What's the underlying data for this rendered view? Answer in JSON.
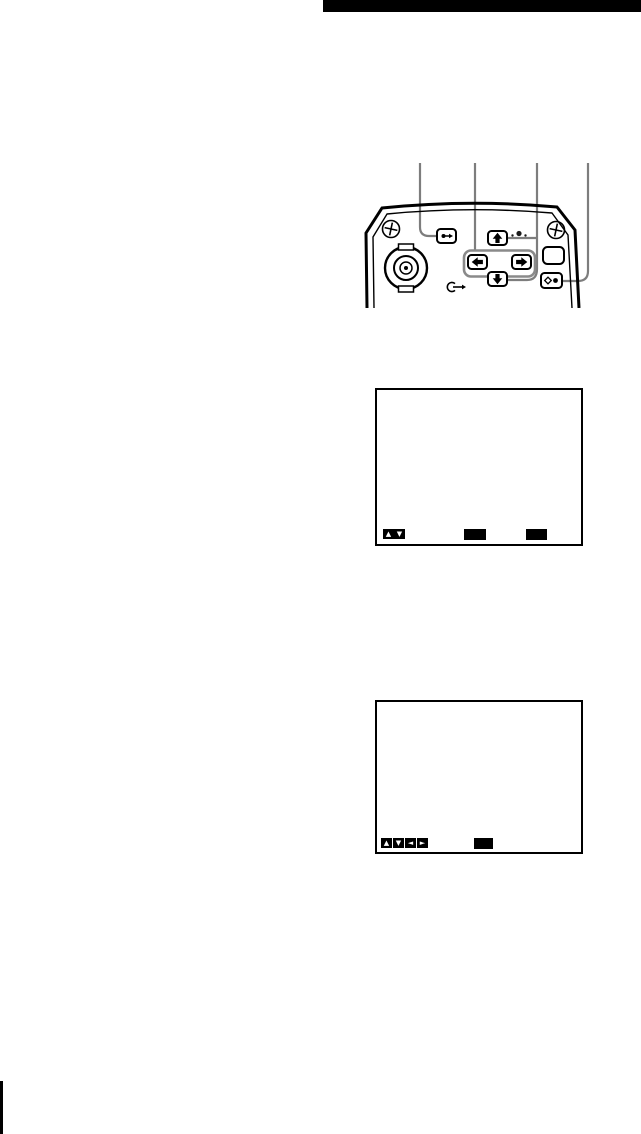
{
  "page": {
    "width": 641,
    "height": 1134,
    "background": "#ffffff"
  },
  "top_rule": {
    "color": "#000000"
  },
  "footer_mark": {
    "color": "#000000"
  },
  "panel_figure": {
    "label": "control-panel-diagram",
    "callout_color": "#7d7d7d",
    "outline_color": "#000000",
    "callout_count": 4,
    "buttons": [
      {
        "name": "menu-button",
        "icon": "dot-arrow-right-icon"
      },
      {
        "name": "up-arrow-button",
        "icon": "up-arrow-icon"
      },
      {
        "name": "left-arrow-button",
        "icon": "left-arrow-icon"
      },
      {
        "name": "right-arrow-button",
        "icon": "right-arrow-icon"
      },
      {
        "name": "down-arrow-button",
        "icon": "down-arrow-icon"
      },
      {
        "name": "blank-button",
        "icon": "none"
      },
      {
        "name": "enter-button",
        "icon": "diamond-dot-icon"
      }
    ],
    "hardware": [
      "screw-icon",
      "screw-icon",
      "bnc-connector-icon",
      "return-arrow-icon",
      "marker-dots-icon"
    ]
  },
  "screens": [
    {
      "name": "menu-screen-1",
      "nav_glyphs": [
        "▲",
        "▼"
      ],
      "label_boxes": 2
    },
    {
      "name": "menu-screen-2",
      "nav_glyphs": [
        "▲",
        "▼",
        "◄",
        "►"
      ],
      "label_boxes": 1
    }
  ]
}
